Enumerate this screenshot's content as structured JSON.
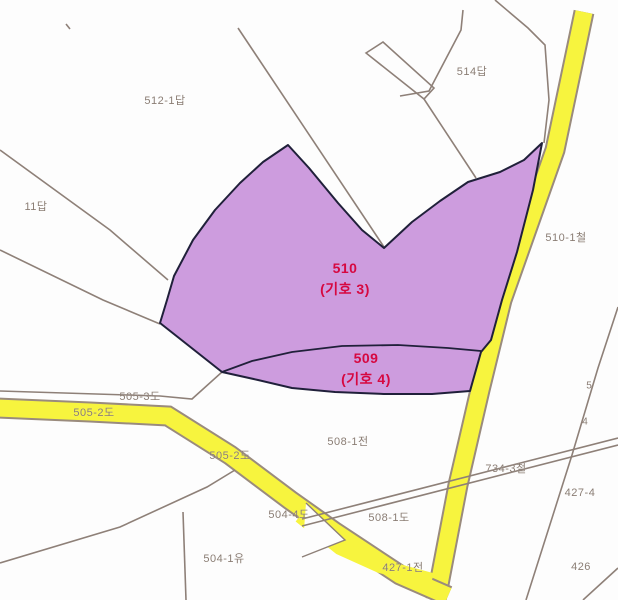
{
  "map": {
    "type": "cadastral-parcel-map",
    "highlighted_parcels": [
      {
        "parcel": "510",
        "marker": "(기호 3)"
      },
      {
        "parcel": "509",
        "marker": "(기호 4)"
      }
    ],
    "colors": {
      "highlight_fill": "#cd9cde",
      "highlight_outline": "#20203a",
      "road_fill": "#f7f43e",
      "parcel_line": "#8e8078",
      "parcel_label": "#8a7d74",
      "highlight_label": "#d60840",
      "background": "#fdfdfd"
    },
    "roads": [
      {
        "name": "510-1철",
        "orientation": "vertical-diagonal"
      },
      {
        "name": "505-2도",
        "orientation": "horizontal-then-diagonal"
      }
    ]
  },
  "labels": [
    {
      "text": "512-1답",
      "x": 165,
      "y": 100,
      "kind": "parcel"
    },
    {
      "text": "514답",
      "x": 472,
      "y": 71,
      "kind": "parcel"
    },
    {
      "text": "11답",
      "x": 36,
      "y": 206,
      "kind": "parcel"
    },
    {
      "text": "510-1철",
      "x": 566,
      "y": 237,
      "kind": "parcel"
    },
    {
      "text": "510",
      "x": 345,
      "y": 268,
      "kind": "highlight"
    },
    {
      "text": "(기호 3)",
      "x": 345,
      "y": 289,
      "kind": "highlight"
    },
    {
      "text": "509",
      "x": 366,
      "y": 358,
      "kind": "highlight"
    },
    {
      "text": "(기호 4)",
      "x": 366,
      "y": 379,
      "kind": "highlight"
    },
    {
      "text": "505-3도",
      "x": 140,
      "y": 396,
      "kind": "parcel"
    },
    {
      "text": "505-2도",
      "x": 94,
      "y": 412,
      "kind": "parcel"
    },
    {
      "text": "505-2도",
      "x": 230,
      "y": 455,
      "kind": "parcel"
    },
    {
      "text": "504-4도",
      "x": 289,
      "y": 514,
      "kind": "parcel"
    },
    {
      "text": "508-1전",
      "x": 348,
      "y": 441,
      "kind": "parcel"
    },
    {
      "text": "508-1도",
      "x": 389,
      "y": 517,
      "kind": "parcel"
    },
    {
      "text": "504-1유",
      "x": 224,
      "y": 558,
      "kind": "parcel"
    },
    {
      "text": "427-1전",
      "x": 403,
      "y": 567,
      "kind": "parcel"
    },
    {
      "text": "426",
      "x": 581,
      "y": 567,
      "kind": "parcel"
    },
    {
      "text": "427-4",
      "x": 580,
      "y": 493,
      "kind": "parcel"
    },
    {
      "text": "734-3철",
      "x": 506,
      "y": 468,
      "kind": "parcel"
    },
    {
      "text": "5",
      "x": 589,
      "y": 386,
      "kind": "fragment"
    },
    {
      "text": "4",
      "x": 585,
      "y": 422,
      "kind": "fragment"
    }
  ]
}
